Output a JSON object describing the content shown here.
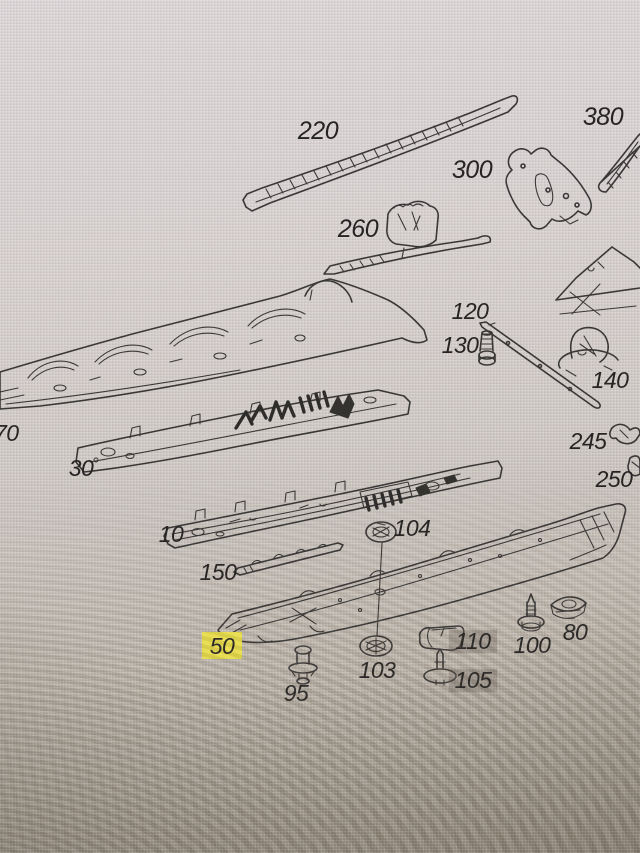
{
  "meta": {
    "description": "Photograph of a computer screen showing an exploded spare-parts line diagram of vehicle floor / underbody panels with numbered callouts",
    "selected_part": "50",
    "gray_marked_parts": [
      "110",
      "105"
    ]
  },
  "colors": {
    "screen_top": "#dad4d5",
    "screen_bottom": "#948a7d",
    "line_art": "#3a3837",
    "label_text": "#262423",
    "highlight_yellow": "#e8dd4c",
    "highlight_gray": "rgba(104,94,85,0.32)"
  },
  "labels": {
    "l220": "220",
    "l380": "380",
    "l300": "300",
    "l260": "260",
    "l120": "120",
    "l130": "130",
    "l140": "140",
    "l245": "245",
    "l250": "250",
    "l70": "70",
    "l30": "30",
    "l10": "10",
    "l150": "150",
    "l104": "104",
    "l50": "50",
    "l103": "103",
    "l95": "95",
    "l110": "110",
    "l105": "105",
    "l100": "100",
    "l80": "80"
  },
  "part_numbers": [
    "10",
    "30",
    "50",
    "70",
    "80",
    "95",
    "100",
    "103",
    "104",
    "105",
    "110",
    "120",
    "130",
    "140",
    "150",
    "220",
    "245",
    "250",
    "260",
    "300",
    "380"
  ]
}
